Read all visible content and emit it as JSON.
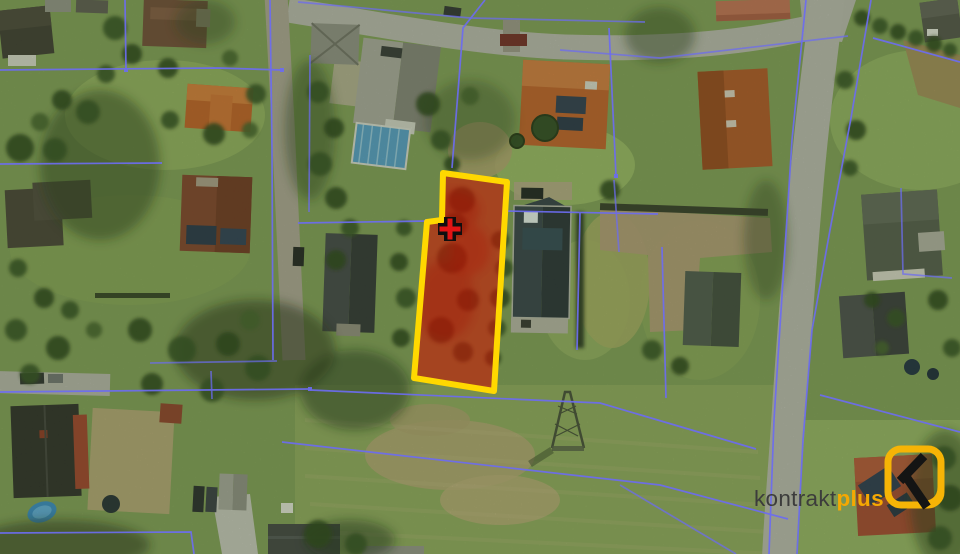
{
  "watermark": {
    "brand_prefix": "kontrakt",
    "brand_suffix": "plus",
    "brand_prefix_color": "#3c3c3c",
    "brand_suffix_color": "#f5a802",
    "icon_outline_color": "#f6b406",
    "icon_glyph_color": "#141414"
  },
  "map": {
    "type": "aerial-photo-with-cadastral-overlay",
    "overlay_colors": {
      "parcel_line": "#6c6cf0",
      "highlight_fill": "rgba(206,20,4,0.58)",
      "highlight_border": "#ffd800",
      "marker_fill": "#e21414",
      "marker_outline": "#0f0f0f"
    },
    "highlighted_plot": {
      "points": "443,173 507,182 494,391 414,378 427,222 442,220",
      "marker_transform": "translate(450,229)"
    }
  }
}
